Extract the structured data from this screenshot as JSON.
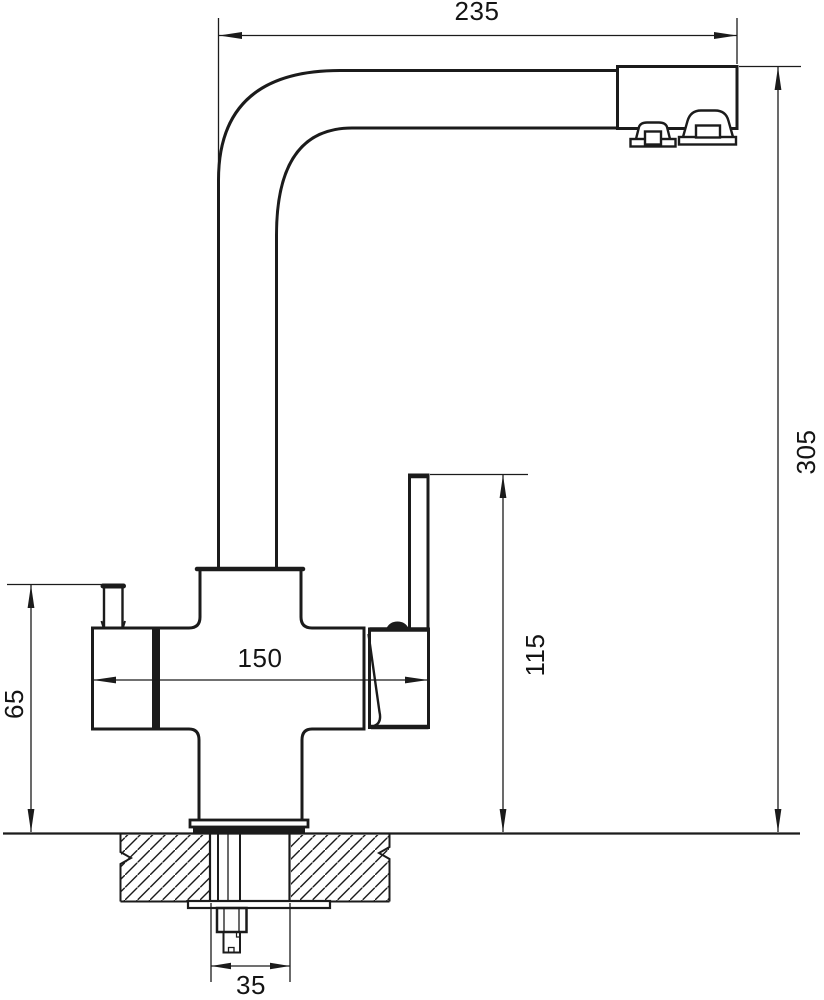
{
  "page": {
    "background_color": "#ffffff",
    "line_color": "#1b1b1b"
  },
  "drawing": {
    "subject": "kitchen faucet with filter channel - technical dimension drawing, side view",
    "dimensions": {
      "spout_reach": "235",
      "overall_height": "305",
      "body_width": "150",
      "lever_height": "115",
      "side_knob_height": "65",
      "mounting_hole_diameter": "35"
    }
  }
}
